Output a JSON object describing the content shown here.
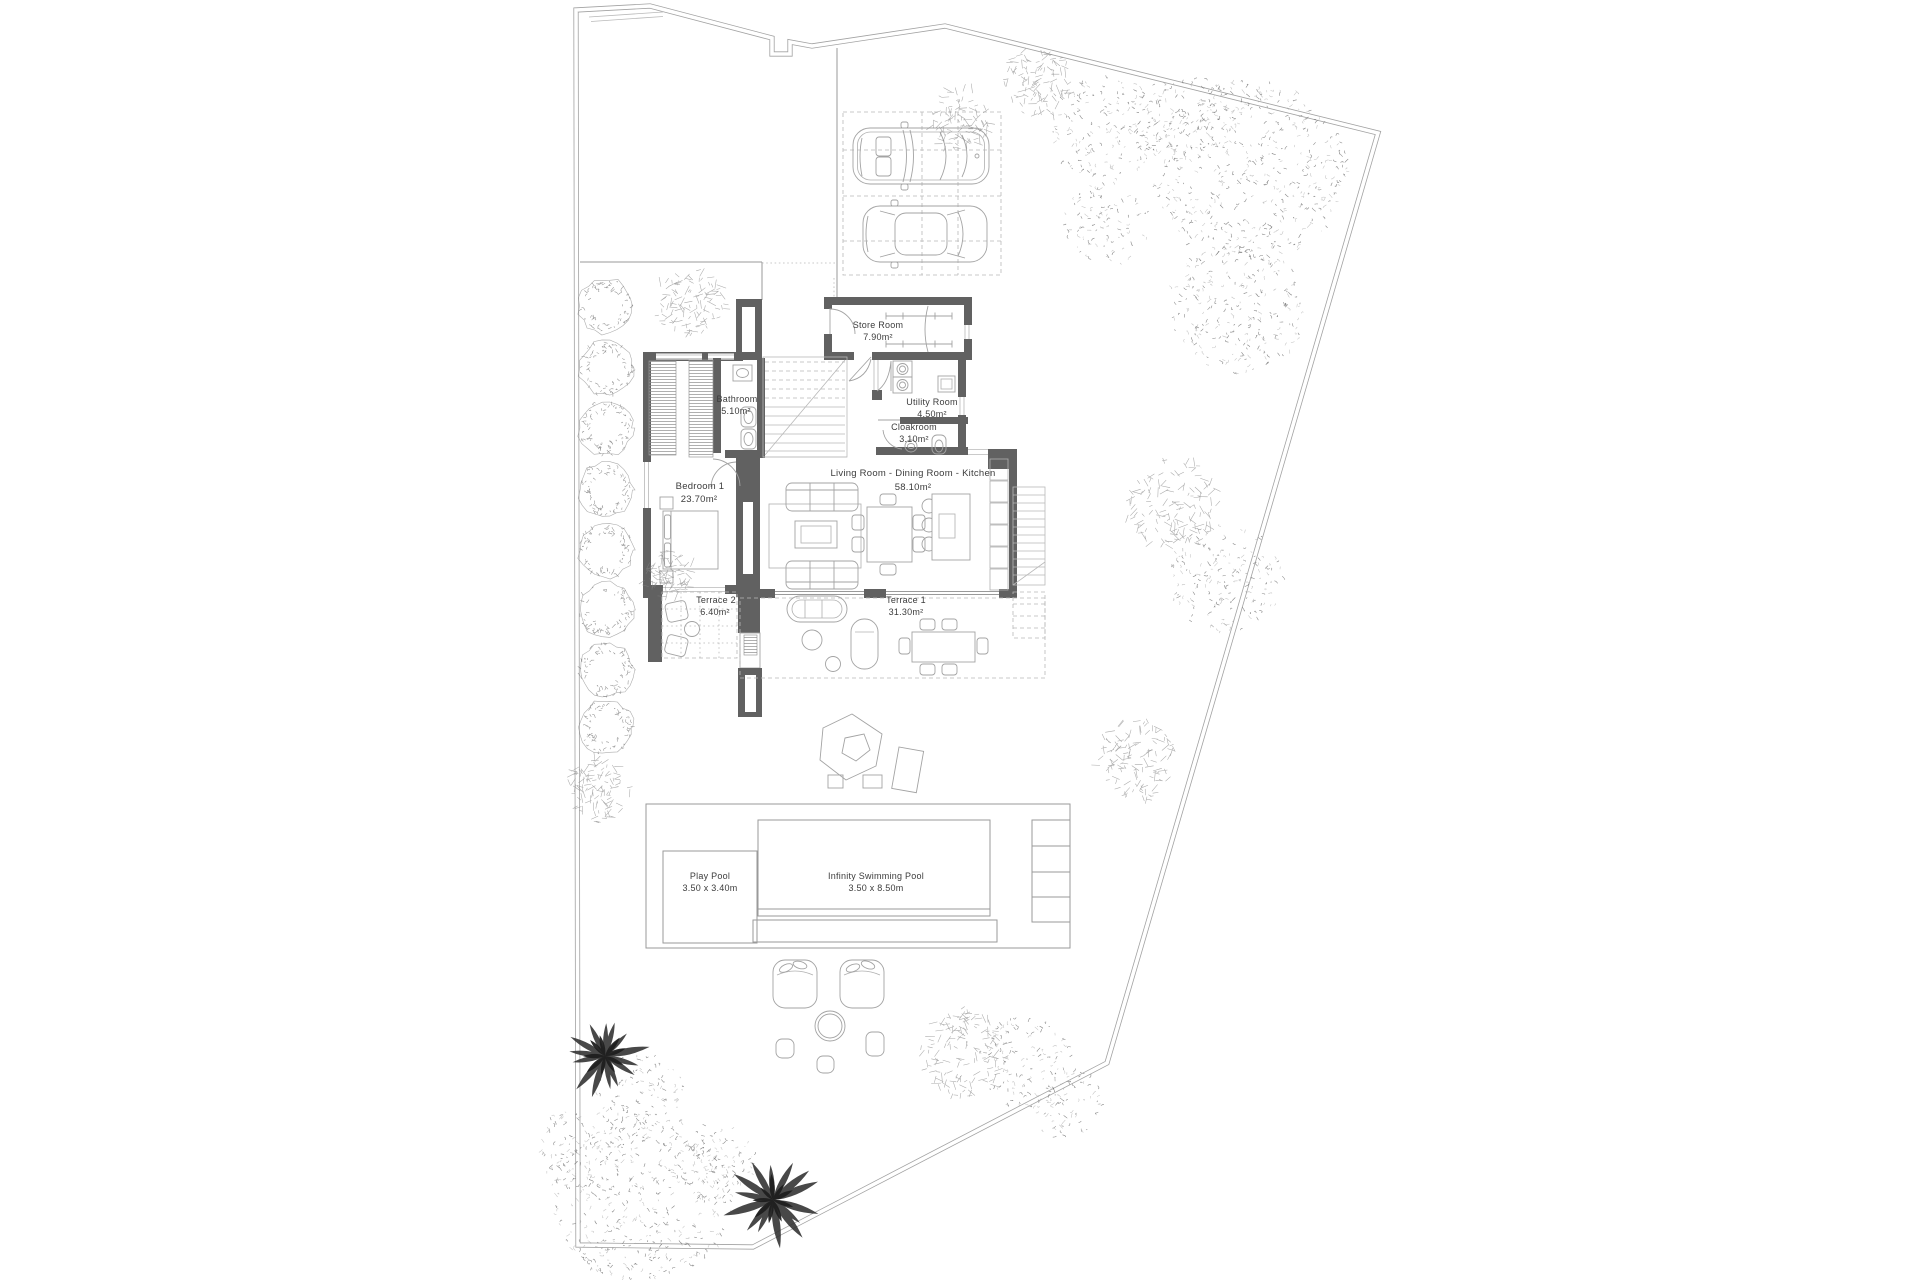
{
  "rooms": {
    "store_room": {
      "name": "Store Room",
      "area": "7.90m²"
    },
    "bathroom": {
      "name": "Bathroom",
      "area": "5.10m²"
    },
    "utility_room": {
      "name": "Utility Room",
      "area": "4.50m²"
    },
    "cloakroom": {
      "name": "Cloakroom",
      "area": "3.10m²"
    },
    "living": {
      "name": "Living Room - Dining Room - Kitchen",
      "area": "58.10m²"
    },
    "bedroom1": {
      "name": "Bedroom 1",
      "area": "23.70m²"
    },
    "terrace2": {
      "name": "Terrace 2",
      "area": "6.40m²"
    },
    "terrace1": {
      "name": "Terrace 1",
      "area": "31.30m²"
    }
  },
  "pools": {
    "play_pool": {
      "name": "Play Pool",
      "size": "3.50 x 3.40m"
    },
    "infinity_pool": {
      "name": "Infinity Swimming Pool",
      "size": "3.50 x 8.50m"
    }
  },
  "colors": {
    "wall": "#616161",
    "line": "#9a9a9a",
    "text": "#3c3c3c",
    "background": "#ffffff"
  }
}
